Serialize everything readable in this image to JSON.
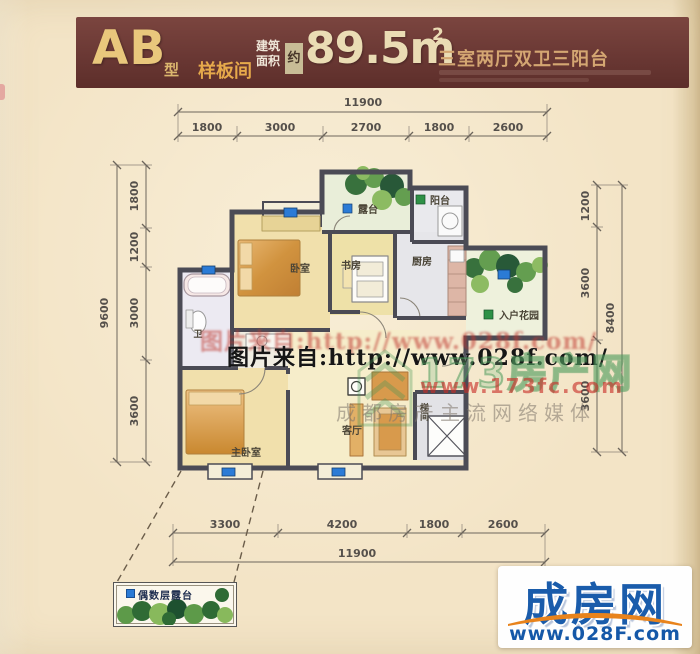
{
  "header": {
    "type_label": "AB",
    "type_suffix": "型",
    "sample_label": "样板间",
    "area_prefix_line1": "建筑",
    "area_prefix_line2": "面积",
    "area_approx": "约",
    "area_value": "89.5m",
    "area_sup": "2",
    "layout_title": "三室两厅双卫三阳台"
  },
  "dimensions": {
    "top": {
      "total": "11900",
      "segments": [
        "1800",
        "3000",
        "2700",
        "1800",
        "2600"
      ]
    },
    "bottom": {
      "total": "11900",
      "segments": [
        "3300",
        "4200",
        "1800",
        "2600"
      ]
    },
    "left": {
      "total": "9600",
      "segments": [
        "1800",
        "1200",
        "3000",
        "3600"
      ]
    },
    "right": {
      "total": "8400",
      "segments": [
        "1200",
        "3600",
        "3600"
      ]
    }
  },
  "rooms": {
    "bedroom": "卧室",
    "study": "书房",
    "kitchen": "厨房",
    "balcony": "阳台",
    "terrace": "露台",
    "entry_garden": "入户花园",
    "master_bedroom": "主卧室",
    "living_room": "客厅",
    "bath": "卫",
    "stair": "梯间"
  },
  "watermarks": {
    "photo_credit_red": "图片来自:http://www.028f.com/",
    "photo_credit_black": "图片来自:http://www.028f.com/",
    "site_name": "173房产网",
    "site_url": "www.173fc.com",
    "site_slogan": "成都房产主流网络媒体"
  },
  "legend": {
    "even_floor_terrace": "偶数层露台"
  },
  "logo": {
    "name": "成房网",
    "url": "www.028F.com"
  },
  "colors": {
    "header_bg": "#6A3834",
    "gold": "#E9C77C",
    "orange_gold": "#E6A94B",
    "title_tan": "#D4A672",
    "dim_text": "#55504B",
    "wall": "#4B4B55",
    "marker_blue": "#2B7BD6",
    "marker_green": "#2E9147",
    "watermark_red": "#C03A32",
    "watermark_green": "#4C9B55",
    "logo_blue": "#1A5CAB",
    "logo_orange": "#E8831C"
  }
}
